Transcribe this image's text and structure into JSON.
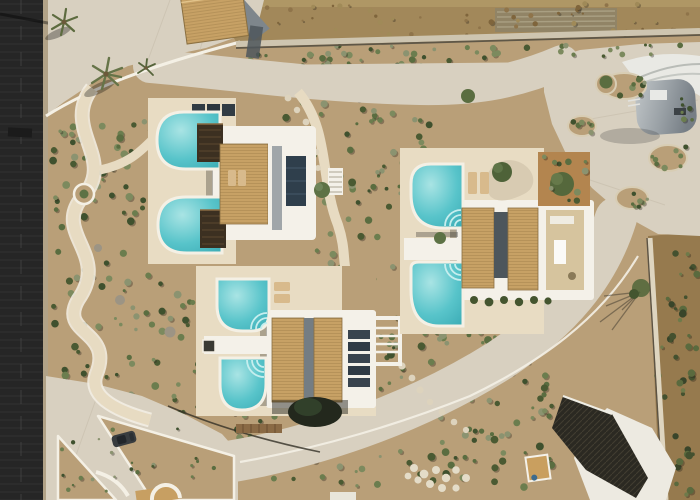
{
  "meta": {
    "title": "Aerial drone view of a whitewashed villa complex with six turquoise swimming pools",
    "type": "aerial photograph",
    "width_px": 700,
    "height_px": 500
  },
  "scene": {
    "description": "Top-down drone photo of a Cycladic-style holiday villa compound: three white villas with timber-slat pergola roofs, six turquoise pools with curved ends and fan steps, sandy landscaped gardens laced with winding white-edged paths, wide concrete driveways, a dark asphalt road along the left edge, dry scrubland above and to the right, a grey vaulted outbuilding beside the parking court, and a shaded carport with a white canopy at the lower right.",
    "objects": {
      "villas": 3,
      "partial_buildings": 3,
      "swimming_pools": 6,
      "spa_deck_boxes": 2,
      "parked_cars": 1,
      "palm_trees": 3,
      "garden_islands": 4,
      "carports": 1
    },
    "palette": {
      "asphalt": "#262626",
      "concrete": "#d8d0c0",
      "deck_sand": "#e8dcc3",
      "villa_white": "#f4f1e9",
      "roof_wood": "#c7a165",
      "roof_wood_dark": "#a8854e",
      "pool_water": "#58c4ca",
      "pool_light": "#a9e4e4",
      "garden_soil": "#b99f78",
      "field_dry": "#a2885a",
      "scrub_dry": "#967a4e",
      "vegetation": "#5d7040",
      "shade_dark": "#2b2922",
      "canopy_white": "#edeae1",
      "gray_building": "#a7adb1",
      "curb_white": "#f4f0e5",
      "wood_box": "#3c3021",
      "soil_orange": "#b3854f",
      "water_step": "#c6eeee"
    }
  }
}
